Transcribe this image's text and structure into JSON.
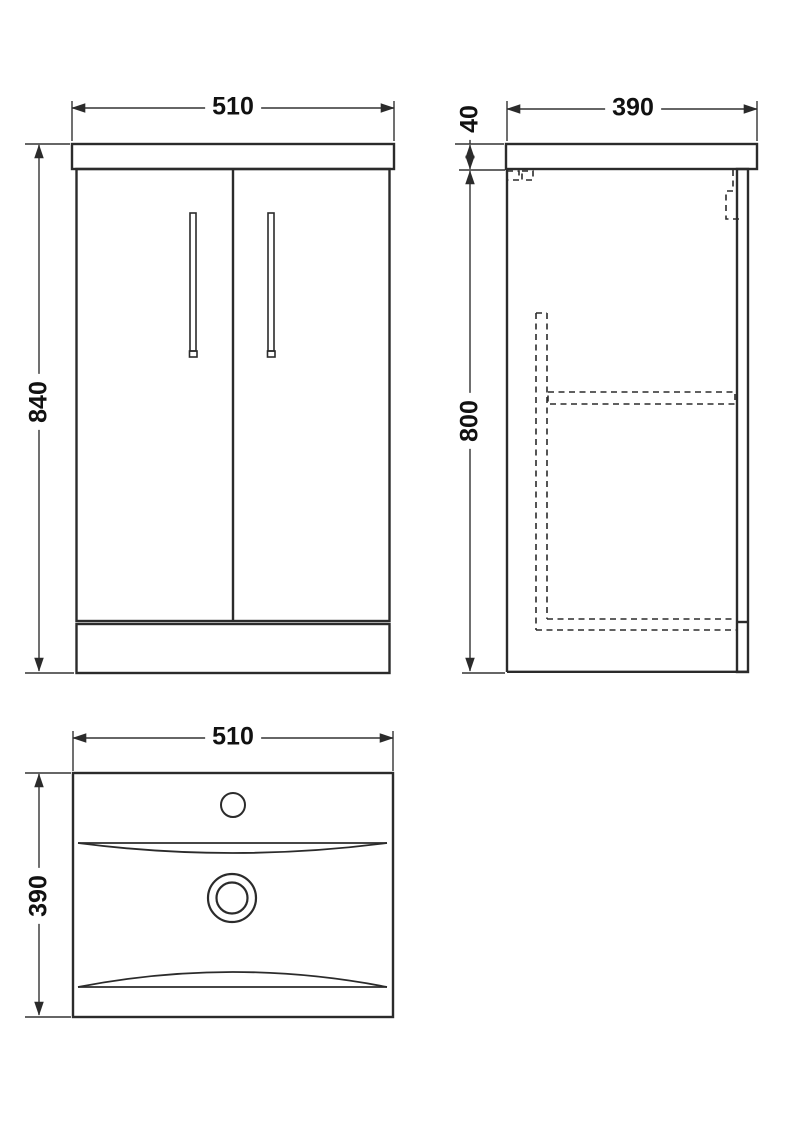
{
  "drawing": {
    "type": "technical-dimension-drawing",
    "subject": "floor-standing vanity unit with basin, three orthographic views",
    "units": "mm",
    "line_color": "#2b2b2b",
    "background_color": "#ffffff",
    "views": {
      "front": {
        "name": "front elevation",
        "width": "510",
        "height": "840"
      },
      "side": {
        "name": "side elevation",
        "depth": "390",
        "counter_thickness": "40",
        "cabinet_height": "800"
      },
      "plan": {
        "name": "plan view of basin",
        "width": "510",
        "depth": "390"
      }
    }
  }
}
